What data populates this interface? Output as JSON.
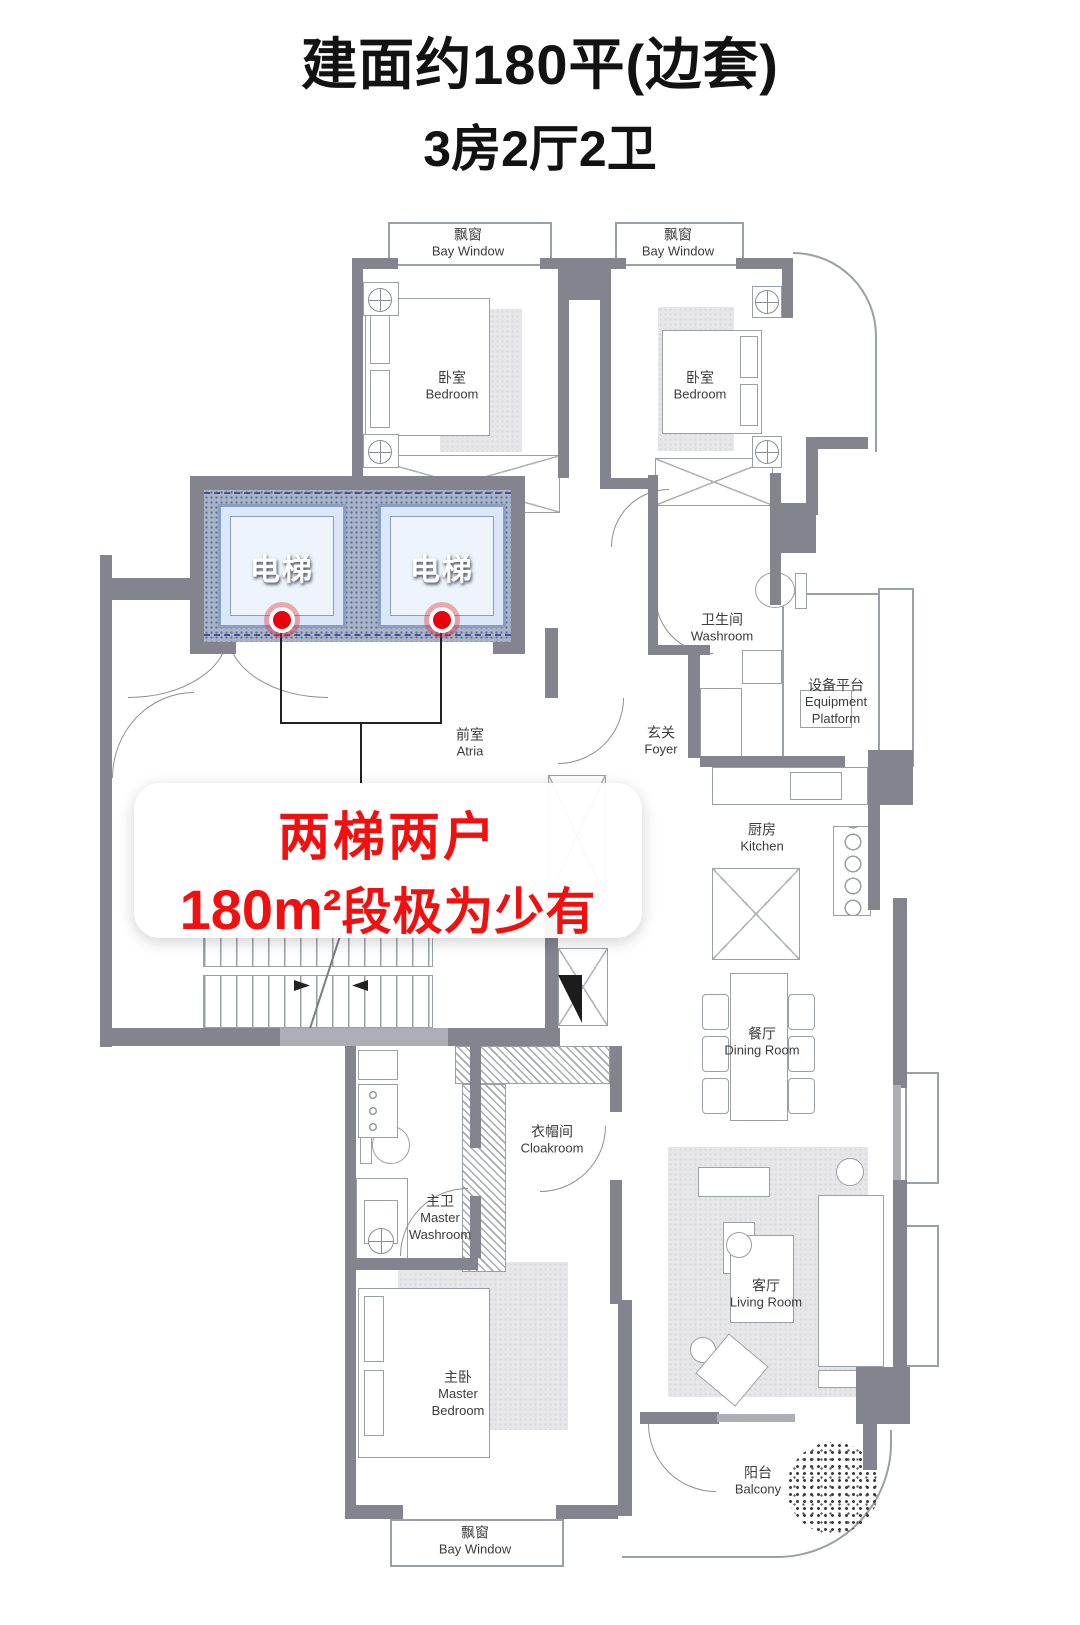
{
  "title": {
    "line1": "建面约180平(边套)",
    "line2": "3房2厅2卫"
  },
  "banner": {
    "line1": "两梯两户",
    "line2_bold": "180m²",
    "line2_rest": "段极为少有"
  },
  "rooms": {
    "bay_window_tl": {
      "zh": "飘窗",
      "en": "Bay Window"
    },
    "bedroom_tl": {
      "zh": "卧室",
      "en": "Bedroom"
    },
    "bay_window_tr": {
      "zh": "飘窗",
      "en": "Bay Window"
    },
    "bedroom_tr": {
      "zh": "卧室",
      "en": "Bedroom"
    },
    "elevator_left": {
      "zh": "电梯"
    },
    "elevator_right": {
      "zh": "电梯"
    },
    "atria": {
      "zh": "前室",
      "en": "Atria"
    },
    "foyer": {
      "zh": "玄关",
      "en": "Foyer"
    },
    "washroom": {
      "zh": "卫生间",
      "en": "Washroom"
    },
    "equipment_platform": {
      "zh": "设备平台",
      "en1": "Equipment",
      "en2": "Platform"
    },
    "kitchen": {
      "zh": "厨房",
      "en": "Kitchen"
    },
    "dining": {
      "zh": "餐厅",
      "en": "Dining Room"
    },
    "cloakroom": {
      "zh": "衣帽间",
      "en": "Cloakroom"
    },
    "master_washroom": {
      "zh": "主卫",
      "en1": "Master",
      "en2": "Washroom"
    },
    "master_bedroom": {
      "zh": "主卧",
      "en1": "Master",
      "en2": "Bedroom"
    },
    "living": {
      "zh": "客厅",
      "en": "Living Room"
    },
    "balcony": {
      "zh": "阳台",
      "en": "Balcony"
    },
    "bay_window_bottom": {
      "zh": "飘窗",
      "en": "Bay Window"
    }
  },
  "colors": {
    "wall": "#84848e",
    "wall_light": "#adaeb6",
    "elevator_fill": "#dbe7f6",
    "elevator_wall": "#aab4c9",
    "accent_red": "#e8000f",
    "banner_text": "#f01010",
    "line": "#9aa0a6"
  }
}
